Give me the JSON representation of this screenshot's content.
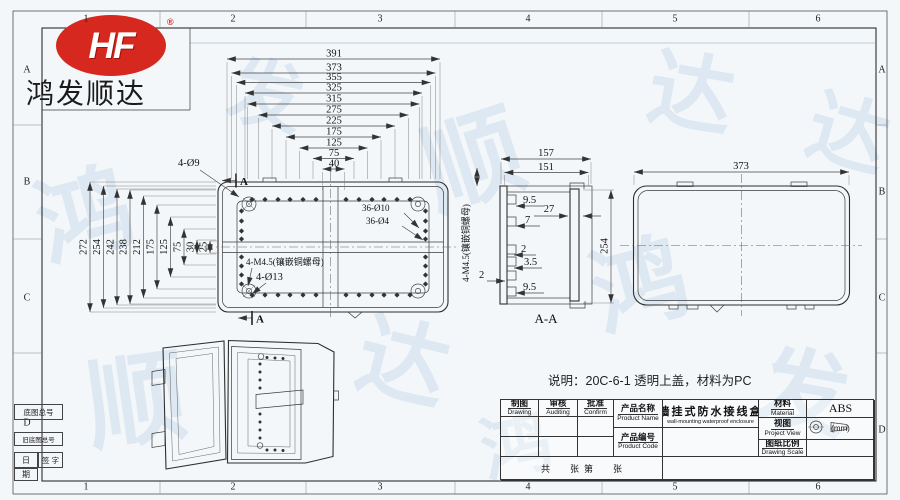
{
  "logo": {
    "text": "HF",
    "registered": "®",
    "company": "鸿发顺达"
  },
  "watermark": {
    "chars": [
      "鸿",
      "发",
      "顺",
      "达"
    ]
  },
  "zones": {
    "top": [
      "1",
      "2",
      "3",
      "4",
      "5",
      "6"
    ],
    "bottom": [
      "1",
      "2",
      "3",
      "4",
      "5",
      "6"
    ],
    "left": [
      "A",
      "B",
      "C",
      "D"
    ],
    "right": [
      "A",
      "B",
      "C",
      "D"
    ]
  },
  "front_view": {
    "top_dims": [
      "391",
      "373",
      "355",
      "325",
      "315",
      "275",
      "225",
      "175",
      "125",
      "75",
      "40"
    ],
    "left_dims": [
      "272",
      "254",
      "242",
      "238",
      "212",
      "175",
      "125",
      "75",
      "30",
      "25"
    ],
    "labels": {
      "holes_outer": "4-Ø9",
      "holes_big": "36-Ø10",
      "holes_small": "36-Ø4",
      "insert": "4-M4.5(镶嵌铜螺母)",
      "corner": "4-Ø13",
      "section_a": "A"
    }
  },
  "section_view": {
    "title": "A-A",
    "side_label": "4-M4.5(镶嵌铜螺母)",
    "dims": {
      "w_outer": "157",
      "w_inner": "151",
      "depth": "27",
      "lip1": "9.5",
      "lip2": "7",
      "t1": "2",
      "t2": "3.5",
      "t3": "2",
      "lip3": "9.5",
      "height": "254"
    }
  },
  "top_view": {
    "width_dim": "373"
  },
  "note": {
    "text": "说明：20C-6-1 透明上盖，材料为PC"
  },
  "title_block": {
    "drawing_cn": "制图",
    "drawing_en": "Drawing",
    "auditing_cn": "审核",
    "auditing_en": "Auditing",
    "confirm_cn": "批准",
    "confirm_en": "Confirm",
    "product_name_cn": "产品名称",
    "product_name_en": "Product Name",
    "product_code_cn": "产品编号",
    "product_code_en": "Product Code",
    "name_value_cn": "墙挂式防水接线盒",
    "name_value_en": "wall-mounting waterproof enclosure",
    "material_cn": "材料",
    "material_en": "Material",
    "material_value": "ABS",
    "view_cn": "视图",
    "view_en": "Project View",
    "unit": "(mm)",
    "scale_cn": "图纸比例",
    "scale_en": "Drawing Scale",
    "sheet_text": "共        张  第        张"
  },
  "margin_fields": {
    "base_no": "底图总号",
    "old_base_no": "旧底图总号",
    "sign": "签  字",
    "date_top": "日",
    "date_bottom": "期"
  },
  "colors": {
    "logo_red": "#d6281e",
    "line": "#3a3a3a",
    "watermark": "#a9c6e0"
  }
}
